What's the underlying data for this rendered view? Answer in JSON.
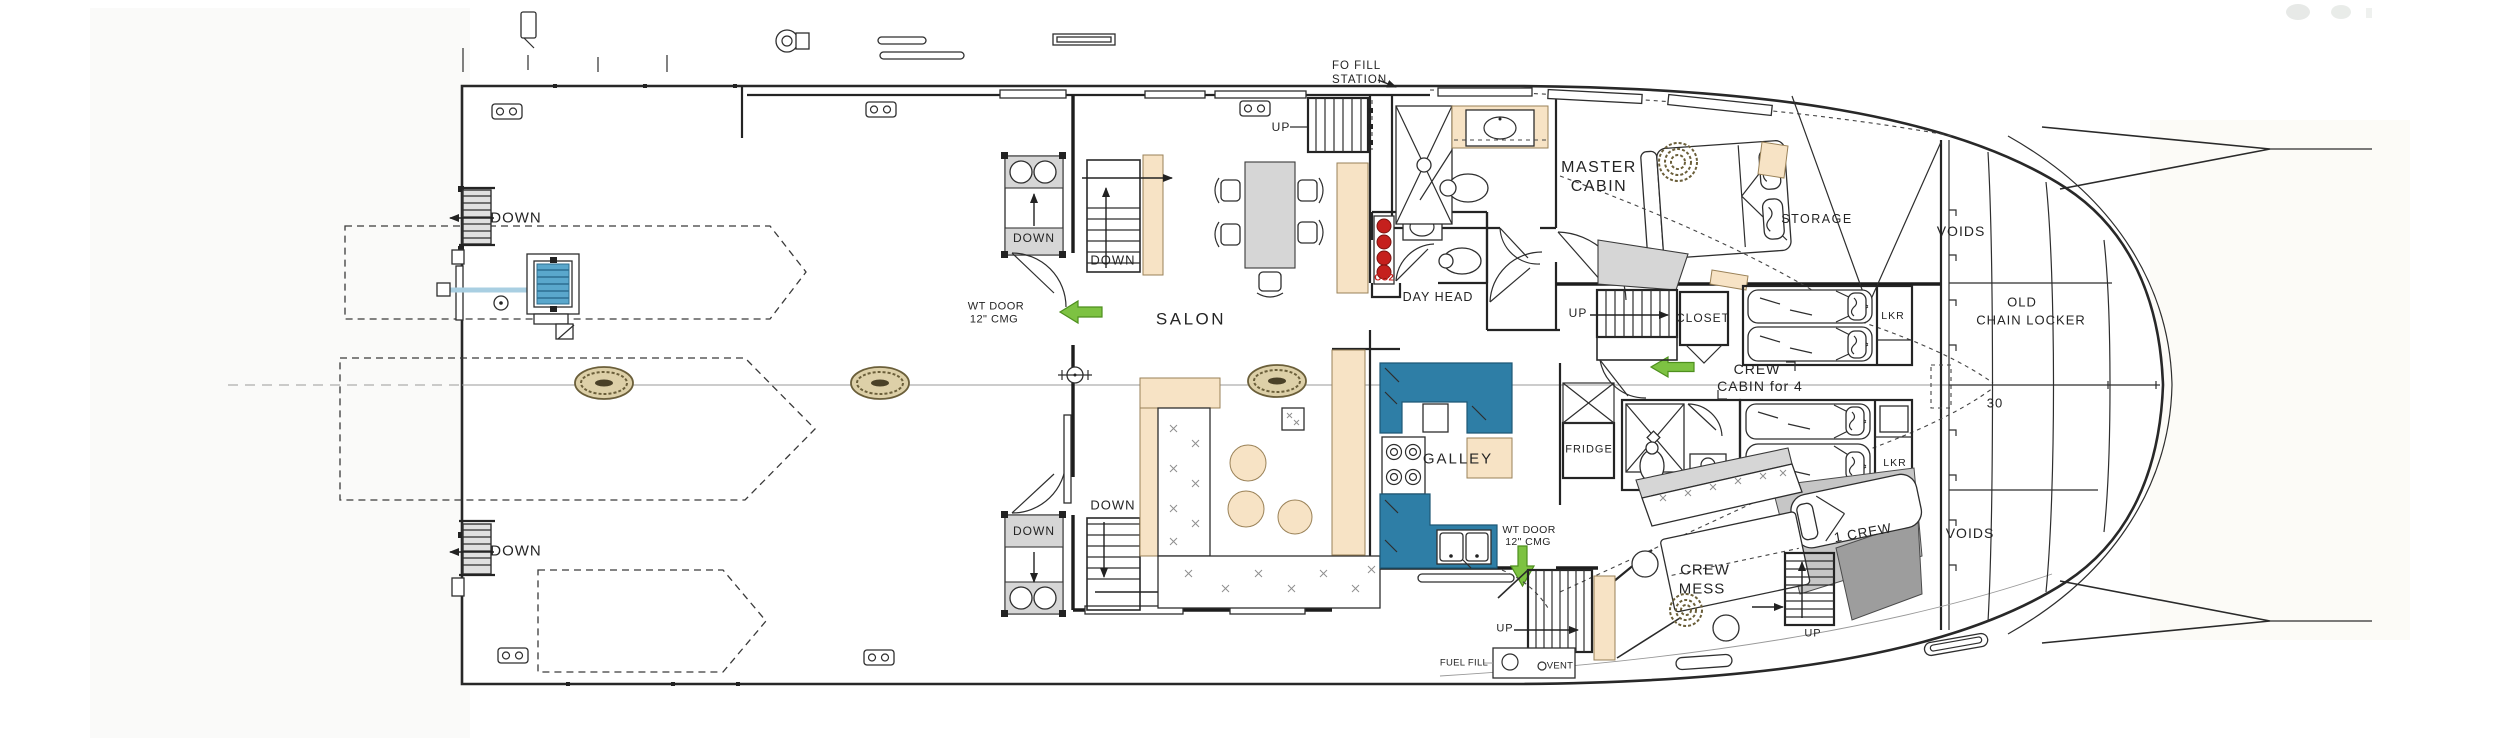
{
  "drawing": {
    "type": "yacht deck arrangement floor plan",
    "labels": {
      "down": "DOWN",
      "up": "UP",
      "salon": "SALON",
      "galley": "GALLEY",
      "wt_door_line1": "WT DOOR",
      "wt_door_line2": "12\" CMG",
      "fo_fill_line1": "FO FILL",
      "fo_fill_line2": "STATION",
      "co2": "CO2",
      "day_head": "DAY HEAD",
      "master_cabin_line1": "MASTER",
      "master_cabin_line2": "CABIN",
      "storage": "STORAGE",
      "voids": "VOIDS",
      "old_chain_locker_line1": "OLD",
      "old_chain_locker_line2": "CHAIN LOCKER",
      "station_number": "30",
      "closet": "CLOSET",
      "crew_cabin_line1": "CREW",
      "crew_cabin_line2": "CABIN for 4",
      "fridge": "FRIDGE",
      "lkr": "LKR",
      "one_crew": "1 CREW",
      "crew_mess_line1": "CREW",
      "crew_mess_line2": "MESS",
      "fuel_fill": "FUEL FILL",
      "vent": "VENT"
    },
    "colors": {
      "accent_tan": "#f7e3c5",
      "galley_teal": "#2e7ea6",
      "co2_red": "#c5201d",
      "arrow_green": "#7dc242",
      "furniture_gray": "#d6d6d6",
      "hatch_olive": "#ddd0a8",
      "rope_blue": "#a9cfe2",
      "line": "#2e2e2e"
    }
  }
}
